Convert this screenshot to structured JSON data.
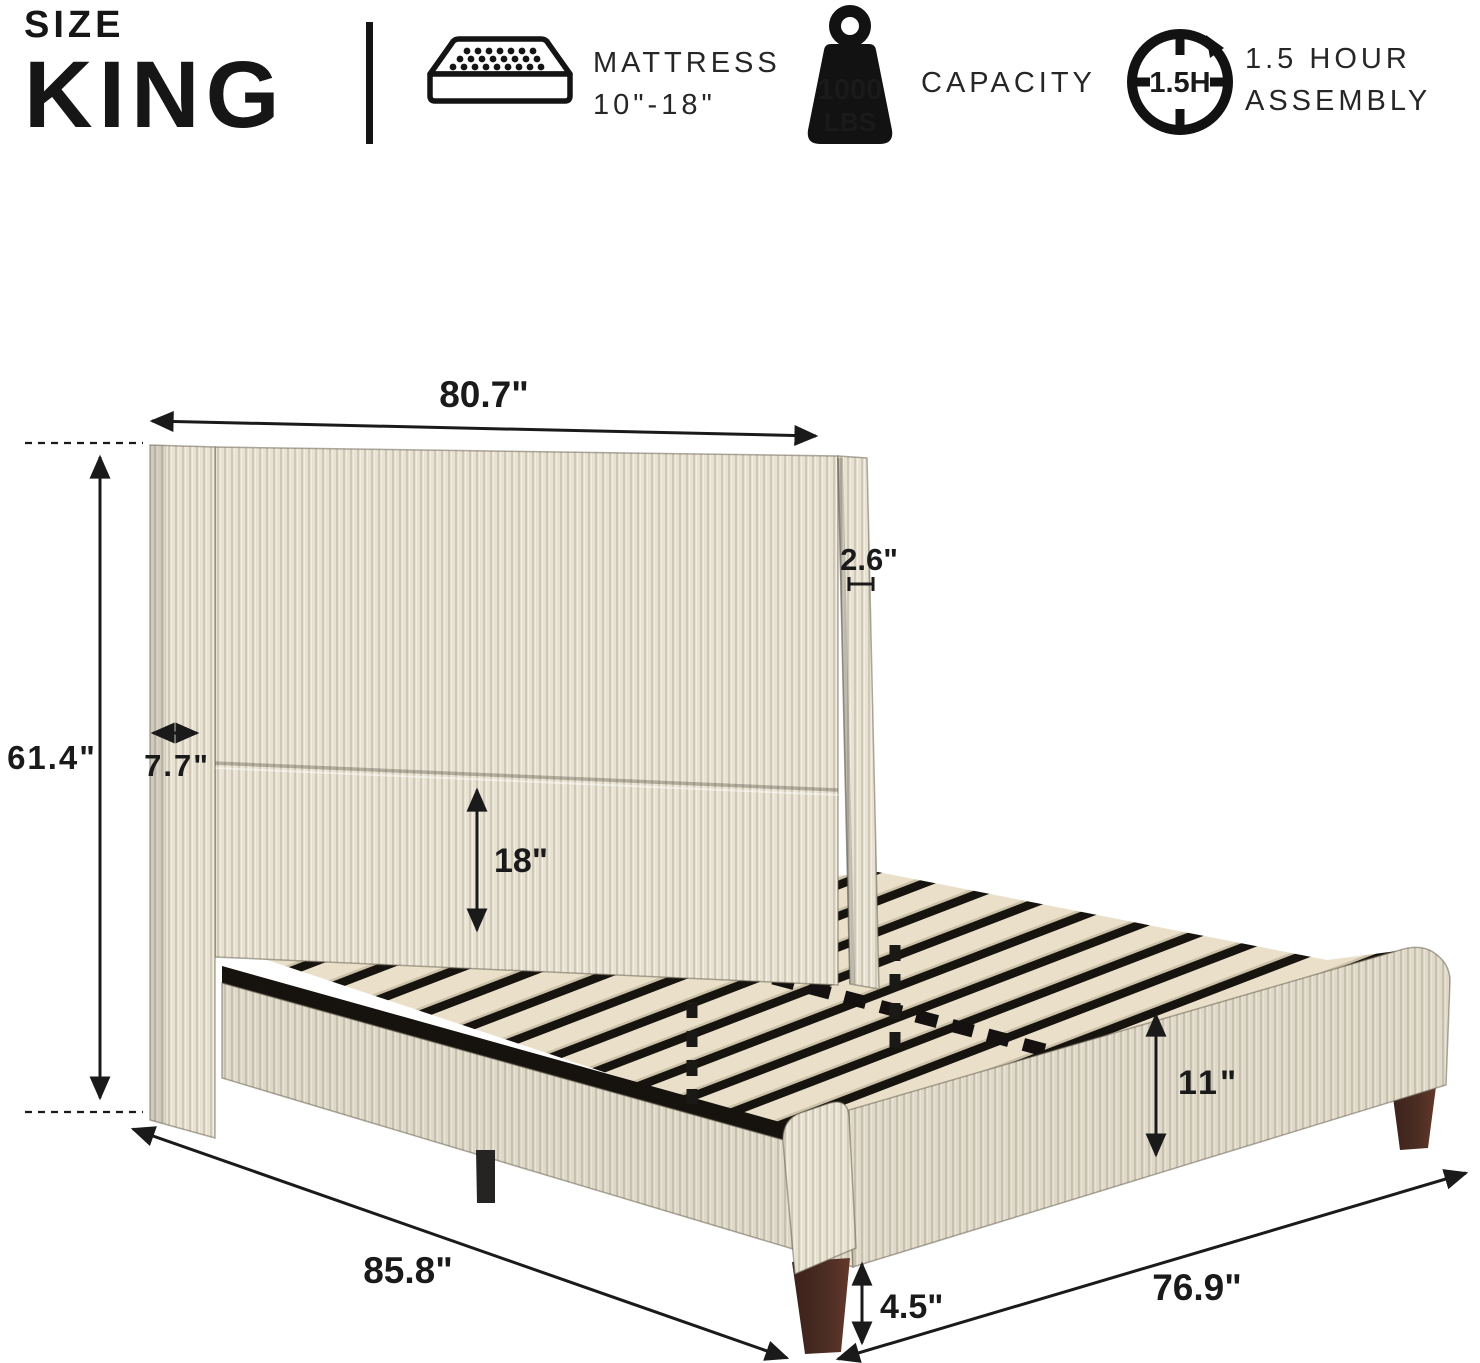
{
  "header": {
    "size_label": "SIZE",
    "size_value": "KING",
    "features": [
      {
        "icon": "mattress-icon",
        "title": "MATTRESS",
        "subtitle": "10\"-18\""
      },
      {
        "icon": "weight-icon",
        "badge_line1": "1000",
        "badge_line2": "LBS",
        "title": "CAPACITY"
      },
      {
        "icon": "clock-icon",
        "clock_label": "1.5H",
        "title": "1.5 HOUR",
        "subtitle": "ASSEMBLY"
      }
    ]
  },
  "diagram": {
    "subject": "upholstered corduroy king platform bed with wingback headboard and wood slats",
    "dimensions": {
      "headboard_width": "80.7\"",
      "wing_thickness": "2.6\"",
      "headboard_height": "61.4\"",
      "headboard_depth": "7.7\"",
      "headboard_panel_height": "18\"",
      "frame_height": "11\"",
      "leg_height": "4.5\"",
      "total_length": "85.8\"",
      "frame_width": "76.9\""
    }
  },
  "colors": {
    "ink": "#1a1a1a",
    "fabric_light": "#e8e2d3",
    "fabric_shadow": "#cfc8b7",
    "slat_wood": "#eae0ca",
    "metal_black": "#262422",
    "leg_brown": "#4a2c22"
  }
}
